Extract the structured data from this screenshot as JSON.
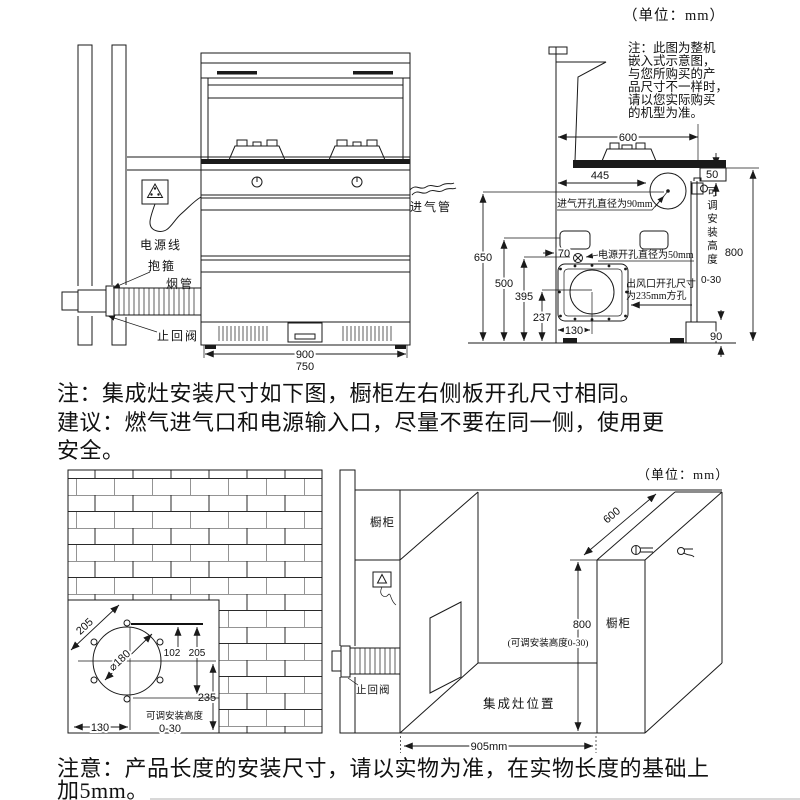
{
  "doc": {
    "unit_top": "（单位：mm）",
    "unit_bottom": "（单位：mm）",
    "mid_note": {
      "line1": "注：集成灶安装尺寸如下图，橱柜左右侧板开孔尺寸相同。",
      "line2": "建议：燃气进气口和电源输入口，尽量不要在同一侧，使用更",
      "line3": "安全。"
    },
    "bottom_note": {
      "line1": "注意：产品长度的安装尺寸，请以实物为准，在实物长度的基础上",
      "line2": "加5mm。"
    }
  },
  "front": {
    "power_cord": "电源线",
    "clamp": "抱箍",
    "flue": "烟管",
    "check_valve": "止回阀",
    "gas_pipe": "进气管",
    "dim_900": "900",
    "dim_750": "750"
  },
  "side": {
    "note": {
      "l1": "注：此图为整机",
      "l2": "嵌入式示意图，",
      "l3": "与您所购买的产",
      "l4": "品尺寸不一样时，",
      "l5": "请以您实际购买",
      "l6": "的机型为准。"
    },
    "dim_600": "600",
    "dim_50": "50",
    "dim_445": "445",
    "dim_650": "650",
    "dim_500": "500",
    "dim_395": "395",
    "dim_237": "237",
    "dim_130": "130",
    "dim_70": "70",
    "dim_800": "800",
    "dim_90": "90",
    "gas_hole_label": "进气开孔直径为90mm",
    "power_hole_label": "电源开孔直径为50mm",
    "outlet_label_1": "出风口开孔尺寸",
    "outlet_label_2": "为235mm方孔",
    "adj_height": "可调安装高度",
    "adj_range": "0-30"
  },
  "wall": {
    "dim_205_diag": "205",
    "dim_180": "⌀180",
    "dim_102": "102",
    "dim_205v": "205",
    "dim_235": "235",
    "dim_130": "130",
    "adj_height": "可调安装高度",
    "adj_range": "0-30"
  },
  "persp": {
    "cabinet_left": "橱柜",
    "cabinet_right": "橱柜",
    "stove_position": "集成灶位置",
    "check_valve": "止回阀",
    "dim_600": "600",
    "dim_800": "800",
    "dim_905": "905mm",
    "adj_note": "(可调安装高度0-30)"
  }
}
